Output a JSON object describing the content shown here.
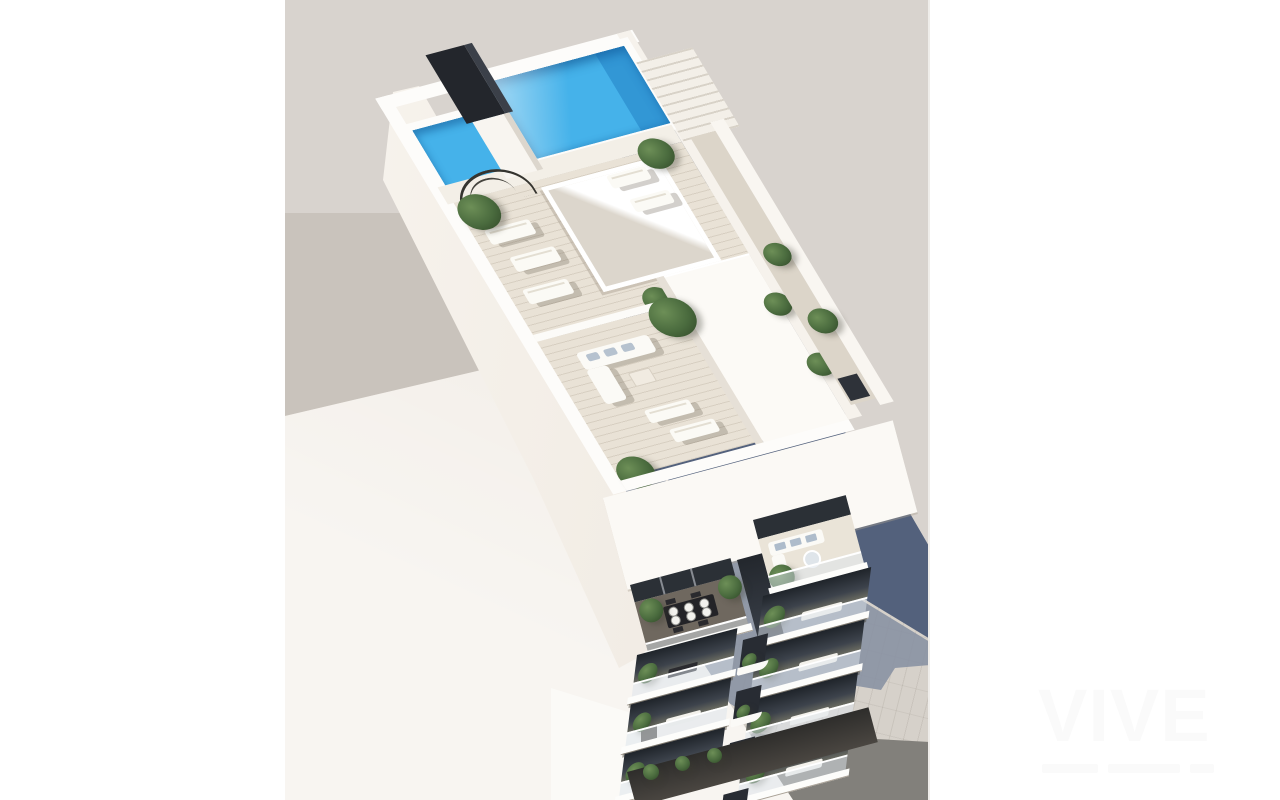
{
  "image": {
    "description": "Aerial 3D architectural render of a white residential building with a rooftop swimming pool, timber sun decks, penthouse terraces and two stacks of plant-lined balconies, casting a stepped shadow onto a neutral backdrop and tiled pavement",
    "view": "top-down aerial render"
  },
  "watermark": {
    "text": "VIVE",
    "color": "#fafafa"
  },
  "palette": {
    "backdrop": "#d8d3ce",
    "backdrop_shaded": "#c9c3bc",
    "building_shadow": "#53617c",
    "ground_shadow": "#8791a2",
    "pavement": "#d6d1ca",
    "road": "#82807b",
    "neighbor_roof": "#efe9e1",
    "building_white": "#fbf9f5",
    "deck": "#e9e2d6",
    "balcony_deck": "#6f685f",
    "pool_water": "#45b2ea",
    "glass": "#2b3036",
    "foliage": "#4a6b3e"
  }
}
